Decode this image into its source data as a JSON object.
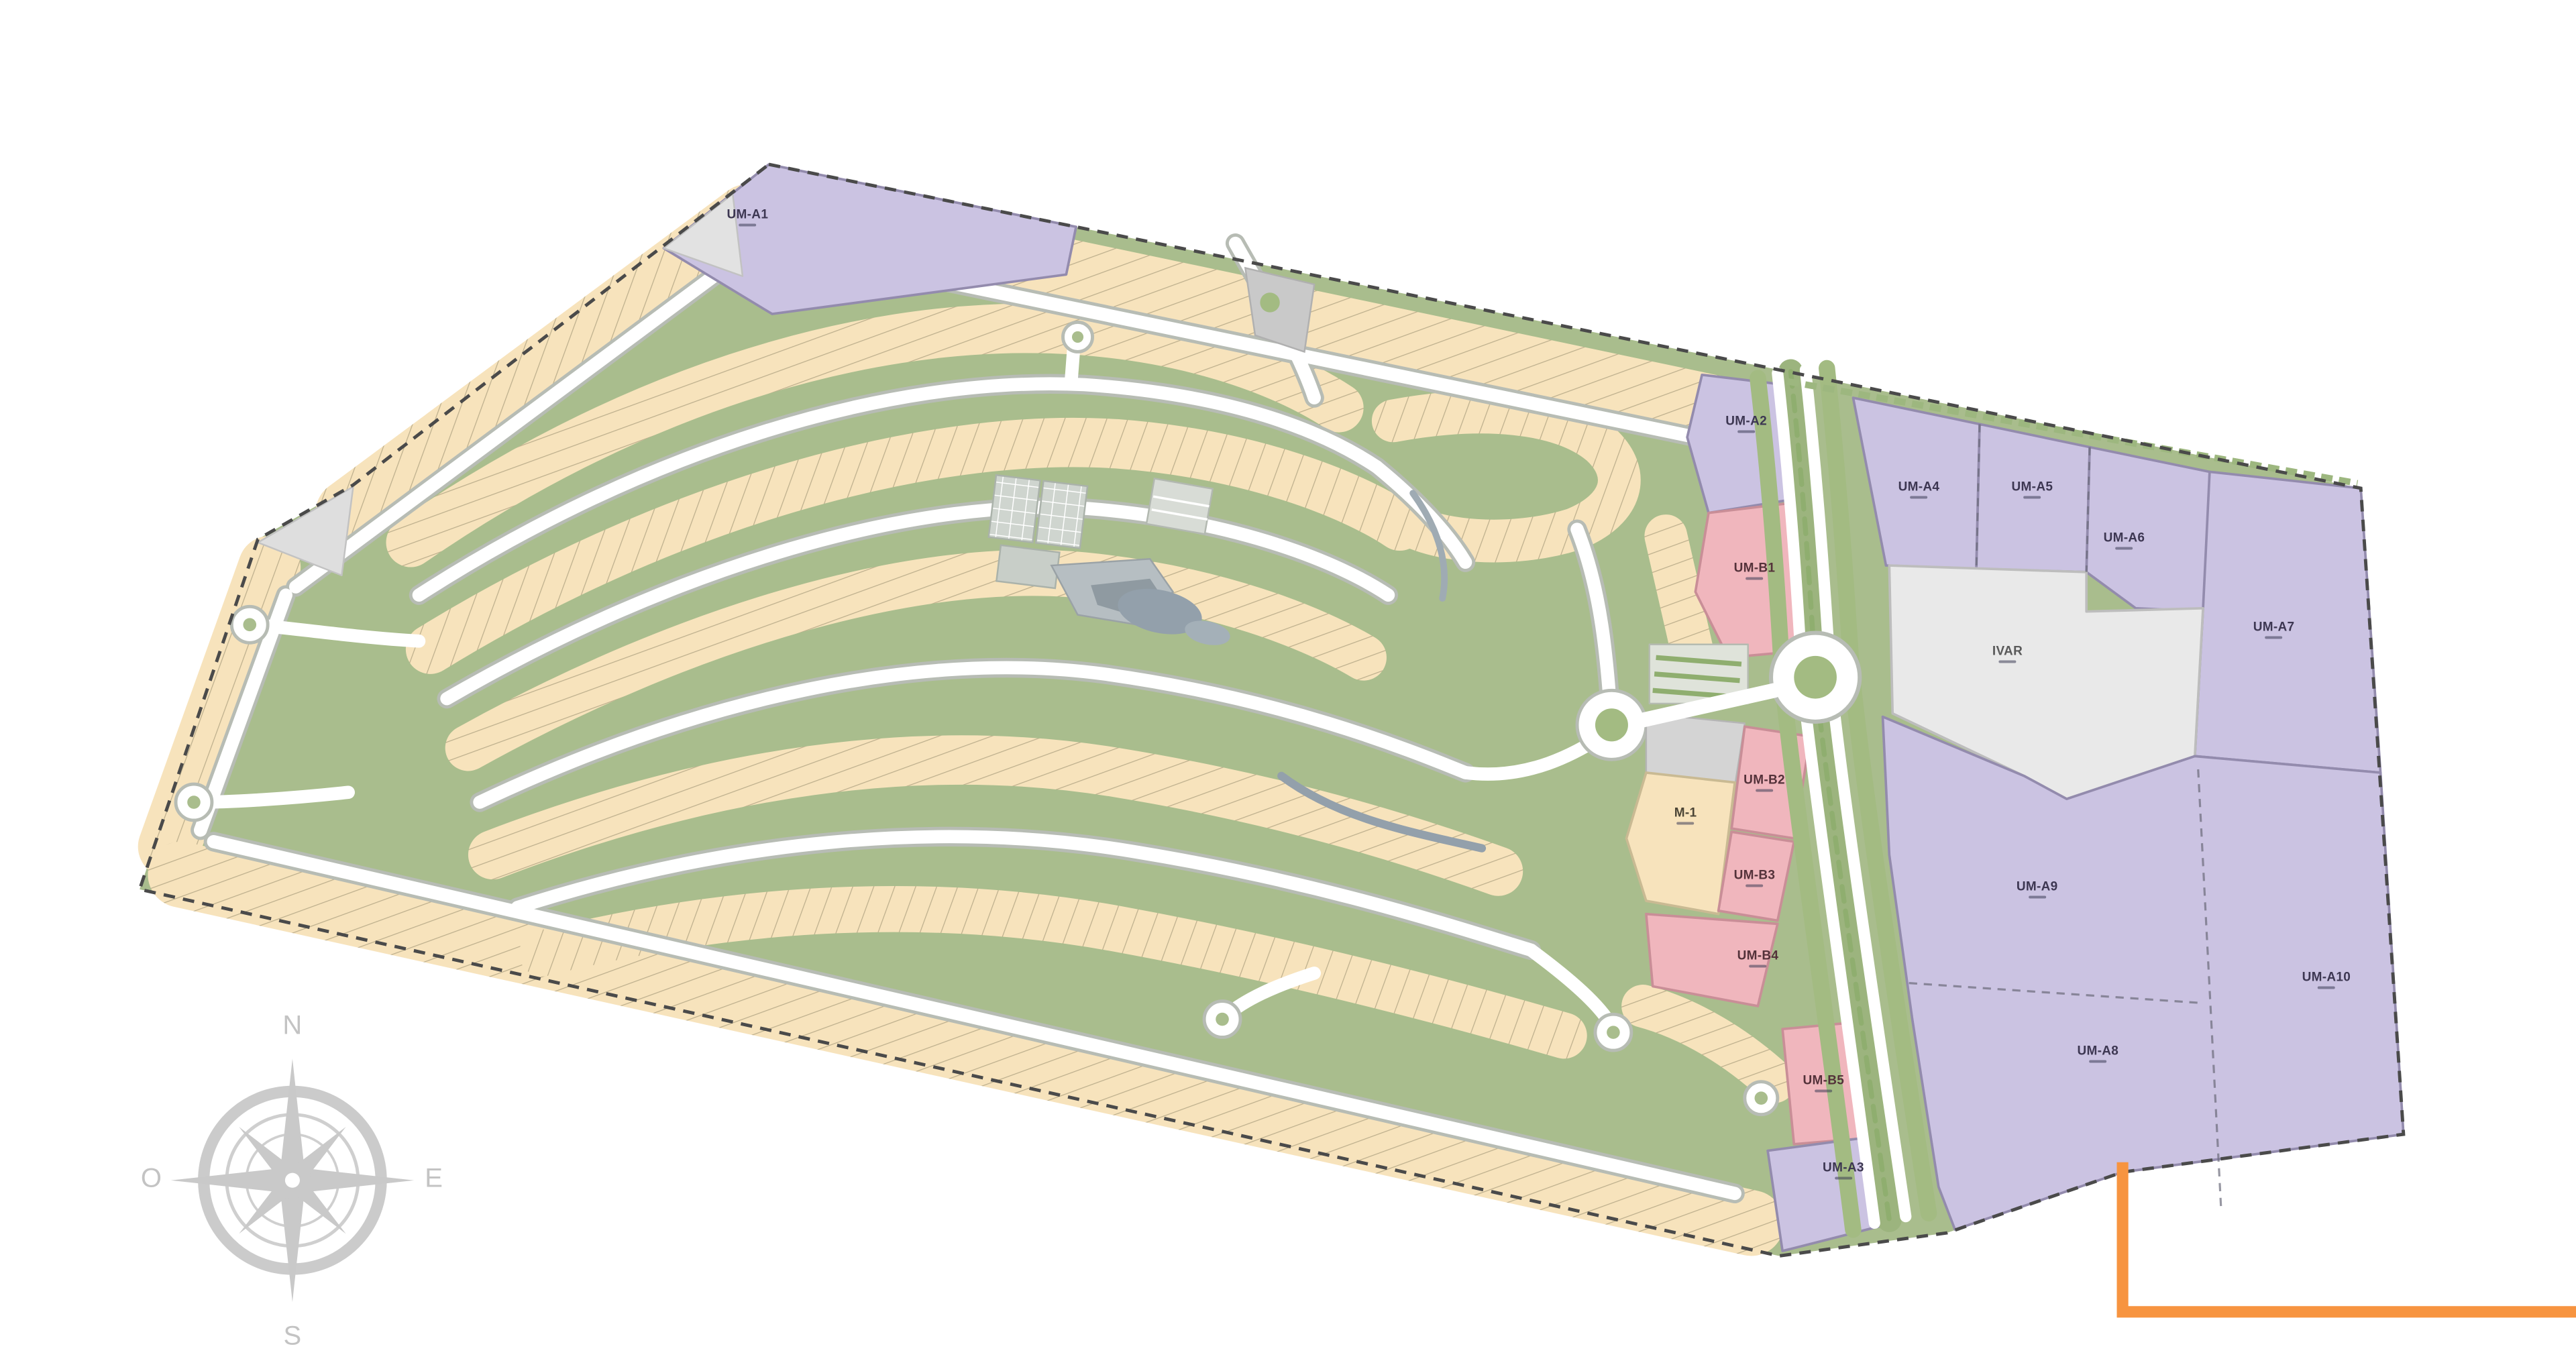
{
  "site": {
    "parcels": {
      "um_a1": "UM-A1",
      "um_a2": "UM-A2",
      "um_a3": "UM-A3",
      "um_a4": "UM-A4",
      "um_a5": "UM-A5",
      "um_a6": "UM-A6",
      "um_a7": "UM-A7",
      "um_a8": "UM-A8",
      "um_a9": "UM-A9",
      "um_a10": "UM-A10",
      "um_b1": "UM-B1",
      "um_b2": "UM-B2",
      "um_b3": "UM-B3",
      "um_b4": "UM-B4",
      "um_b5": "UM-B5",
      "m1": "M-1",
      "ivar": "IVAR"
    },
    "compass": {
      "n": "N",
      "s": "S",
      "e": "E",
      "o": "O"
    },
    "colors": {
      "residential_lot": "#f7e3bc",
      "open_space": "#a9bd8d",
      "urban_mixed_purple": "#cbc3e2",
      "multifamily_pink": "#f0b6bd",
      "facility_gray": "#e9e9e9",
      "road_white": "#ffffff",
      "accent_orange": "#f79440",
      "compass_gray": "#c6c6c6"
    }
  }
}
